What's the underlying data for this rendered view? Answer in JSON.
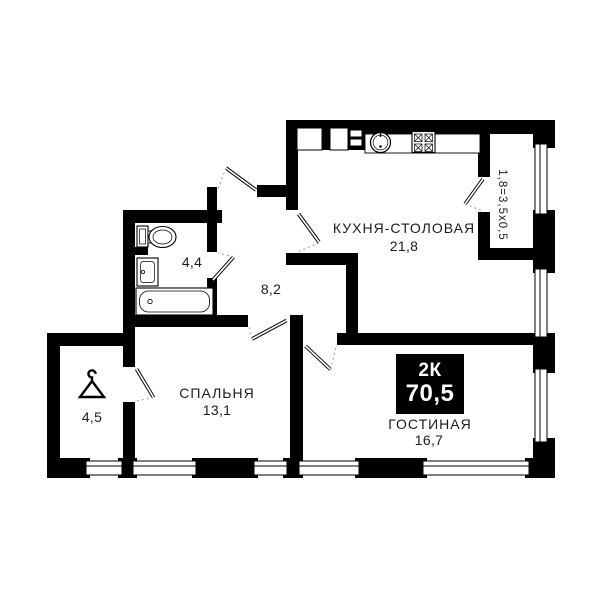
{
  "plan": {
    "badge": {
      "type": "2К",
      "total_area": "70,5"
    },
    "rooms": {
      "kitchen": {
        "name": "КУХНЯ-СТОЛОВАЯ",
        "area": "21,8"
      },
      "hallway": {
        "area": "8,2"
      },
      "bathroom": {
        "area": "4,4"
      },
      "wardrobe": {
        "area": "4,5"
      },
      "bedroom": {
        "name": "СПАЛЬНЯ",
        "area": "13,1"
      },
      "living_room": {
        "name": "ГОСТИНАЯ",
        "area": "16,7"
      }
    },
    "balcony": {
      "dimension": "1,8=3,5x0,5"
    },
    "colors": {
      "wall": "#000000",
      "background": "#ffffff",
      "badge_bg": "#000000",
      "badge_text": "#ffffff"
    }
  }
}
